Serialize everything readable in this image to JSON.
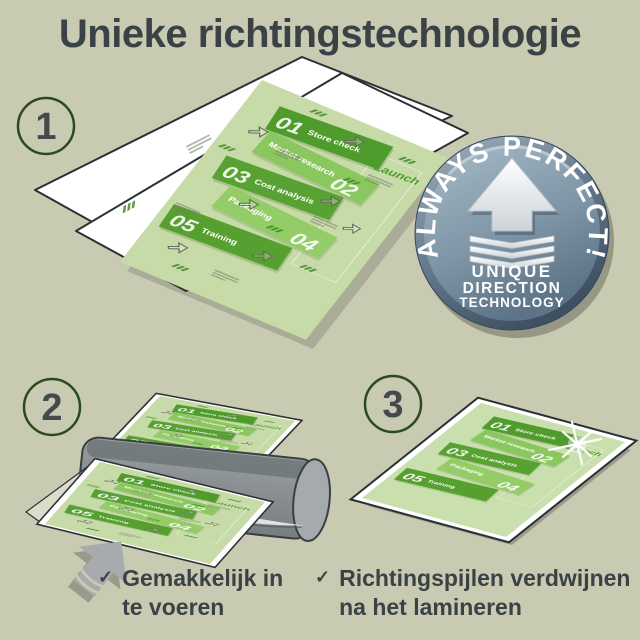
{
  "title": "Unieke richtingstechnologie",
  "steps": [
    {
      "number": "1"
    },
    {
      "number": "2"
    },
    {
      "number": "3"
    }
  ],
  "badge": {
    "arc_text": "ALWAYS PERFECT!",
    "line1": "UNIQUE",
    "line2": "DIRECTION",
    "line3": "TECHNOLOGY"
  },
  "document": {
    "launch": "Launch",
    "bands": [
      {
        "num": "01",
        "label": "Store check"
      },
      {
        "num": "02",
        "label": "Market research"
      },
      {
        "num": "03",
        "label": "Cost analysis"
      },
      {
        "num": "04",
        "label": "Packaging"
      },
      {
        "num": "05",
        "label": "Training"
      }
    ]
  },
  "captions": [
    {
      "mark": "✓",
      "text": "Gemakkelijk in te voeren"
    },
    {
      "mark": "✓",
      "text": "Richtingspijlen verdwijnen na het lamineren"
    }
  ],
  "colors": {
    "background": "#c9cab2",
    "text_dark": "#3b4245",
    "band_dark_green": "#4f9c2c",
    "band_light_green": "#8bc75f",
    "document_bg": "#c6dba7",
    "badge_blue": "#7d95a6",
    "laminator_gray": "#8d9294",
    "circle_green": "#2c4a22"
  }
}
